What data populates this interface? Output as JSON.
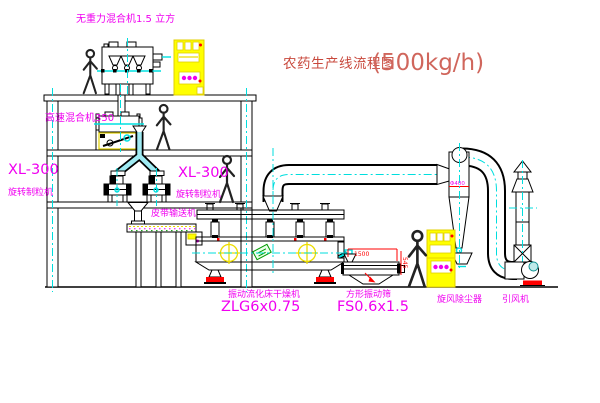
{
  "diagram": {
    "title": {
      "text": "农药生产线流程图",
      "capacity": "(500kg/h)"
    },
    "labels": {
      "gravity_mixer": "无重力混合机1.5 立方",
      "high_speed_mixer": "高速混合机350",
      "granulator_left_model": "XL-300",
      "granulator_left_name": "旋转制粒机",
      "granulator_center_model": "XL-300",
      "granulator_center_name": "旋转制粒机",
      "belt_conveyor": "皮带输送机",
      "dryer_name": "振动流化床干燥机",
      "dryer_model": "ZLG6x0.75",
      "screen_name": "方形振动筛",
      "screen_model": "FS0.6x1.5",
      "cyclone_name": "旋风除尘器",
      "fan_name": "引风机"
    },
    "dimensions": {
      "cyclone_note": "Φ400",
      "screen_length": "1500",
      "screen_height": "545"
    },
    "colors": {
      "label_magenta": "#f000f0",
      "title_red": "#c8483c",
      "centerline_cyan": "#00dede",
      "cabinet_yellow": "#ffff00",
      "accent_red": "#ff0000",
      "accent_green": "#009900",
      "line_black": "#000000"
    }
  }
}
